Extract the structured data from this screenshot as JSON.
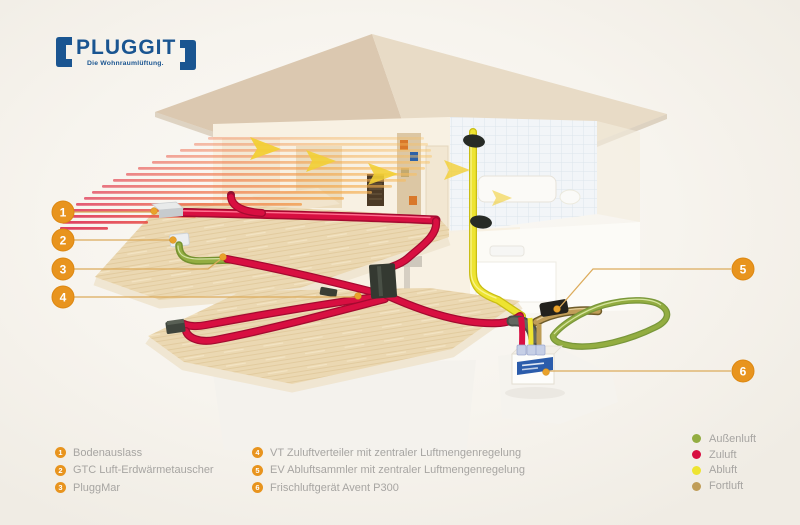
{
  "logo": {
    "name": "PLUGGIT",
    "tagline": "Die Wohnraumlüftung."
  },
  "colors": {
    "logo_blue": "#1a5591",
    "callout": "#e8941e",
    "callout_line": "#dcab5b",
    "legend_text": "#a7a5a2"
  },
  "callouts": [
    {
      "number": "1",
      "label": "Bodenauslass"
    },
    {
      "number": "2",
      "label": "GTC Luft-Erdwärmetauscher"
    },
    {
      "number": "3",
      "label": "PluggMar"
    },
    {
      "number": "4",
      "label": "VT Zuluftverteiler mit zentraler Luftmengenregelung"
    },
    {
      "number": "5",
      "label": "EV Abluftsammler mit zentraler Luftmengenregelung"
    },
    {
      "number": "6",
      "label": "Frischluftgerät Avent P300"
    }
  ],
  "airflow_legend": [
    {
      "label": "Außenluft",
      "color": "#93ad41"
    },
    {
      "label": "Zuluft",
      "color": "#d80f41"
    },
    {
      "label": "Abluft",
      "color": "#eee431"
    },
    {
      "label": "Fortluft",
      "color": "#c09d58"
    }
  ]
}
